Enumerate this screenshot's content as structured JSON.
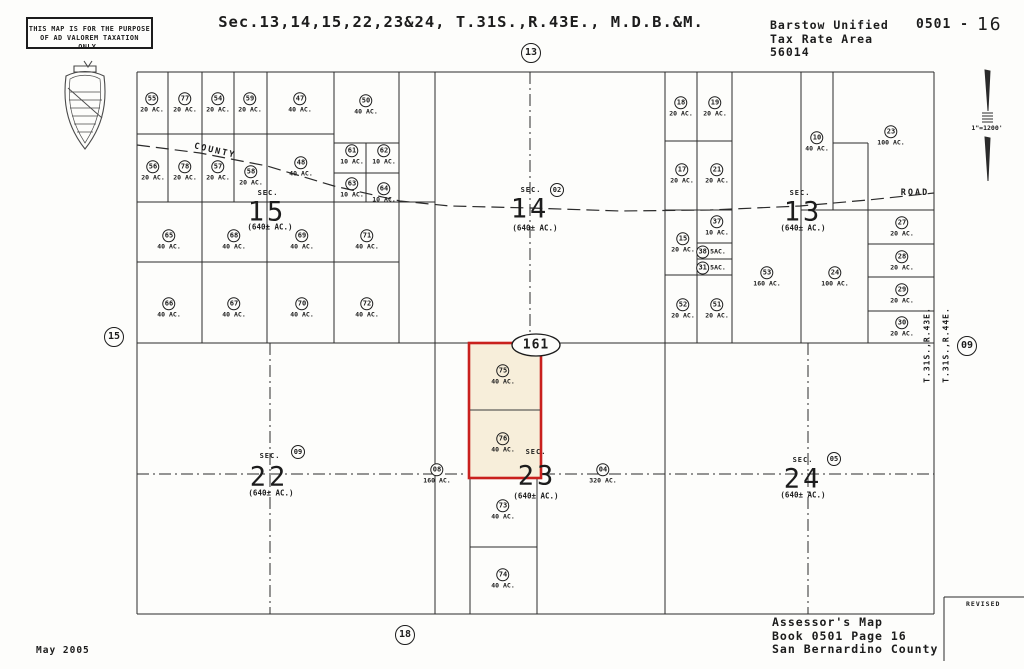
{
  "page": {
    "stamp": [
      "THIS MAP IS FOR THE PURPOSE",
      "OF AD VALOREM TAXATION ONLY."
    ],
    "title": "Sec.13,14,15,22,23&24, T.31S.,R.43E., M.D.B.&M.",
    "district": [
      "Barstow Unified",
      "Tax Rate Area",
      "56014"
    ],
    "sheet_prefix": "0501 -",
    "sheet_page": "16",
    "scale": "1\"=1200'",
    "date": "May 2005",
    "revised": "REVISED",
    "assessor": [
      "Assessor's Map",
      "Book 0501 Page 16",
      "San Bernardino County"
    ],
    "townships": [
      "T.31S.,R.43E.",
      "T.31S.,R.44E."
    ]
  },
  "edge_refs": {
    "top": "13",
    "left": "15",
    "right": "09",
    "bottom": "18"
  },
  "roads": {
    "county": "COUNTY",
    "road": "ROAD"
  },
  "highlight": {
    "flag": "161"
  },
  "sections": [
    {
      "sec": "SEC.",
      "num": "15",
      "size": "(640± AC.)"
    },
    {
      "sec": "SEC.",
      "num": "14",
      "size": "(640± AC.)",
      "ref": "02"
    },
    {
      "sec": "SEC.",
      "num": "13",
      "size": "(640± AC.)"
    },
    {
      "sec": "SEC.",
      "num": "22",
      "size": "(640± AC.)",
      "ref": "09"
    },
    {
      "sec": "SEC.",
      "num": "23",
      "size": "(640± AC.)"
    },
    {
      "sec": "SEC.",
      "num": "24",
      "size": "(640± AC.)",
      "ref": "05"
    }
  ],
  "parcels": [
    {
      "num": "55",
      "ac": "20 AC."
    },
    {
      "num": "77",
      "ac": "20 AC."
    },
    {
      "num": "54",
      "ac": "20 AC."
    },
    {
      "num": "59",
      "ac": "20 AC."
    },
    {
      "num": "47",
      "ac": "40 AC."
    },
    {
      "num": "50",
      "ac": "40 AC."
    },
    {
      "num": "56",
      "ac": "20 AC."
    },
    {
      "num": "78",
      "ac": "20 AC."
    },
    {
      "num": "57",
      "ac": "20 AC."
    },
    {
      "num": "58",
      "ac": "20 AC."
    },
    {
      "num": "48",
      "ac": "40 AC."
    },
    {
      "num": "61",
      "ac": "10 AC."
    },
    {
      "num": "62",
      "ac": "10 AC."
    },
    {
      "num": "63",
      "ac": "10 AC."
    },
    {
      "num": "64",
      "ac": "10 AC."
    },
    {
      "num": "65",
      "ac": "40 AC."
    },
    {
      "num": "68",
      "ac": "40 AC."
    },
    {
      "num": "69",
      "ac": "40 AC."
    },
    {
      "num": "71",
      "ac": "40 AC."
    },
    {
      "num": "66",
      "ac": "40 AC."
    },
    {
      "num": "67",
      "ac": "40 AC."
    },
    {
      "num": "70",
      "ac": "40 AC."
    },
    {
      "num": "72",
      "ac": "40 AC."
    },
    {
      "num": "18",
      "ac": "20 AC."
    },
    {
      "num": "19",
      "ac": "20 AC."
    },
    {
      "num": "10",
      "ac": "40 AC."
    },
    {
      "num": "23",
      "ac": "100 AC."
    },
    {
      "num": "17",
      "ac": "20 AC."
    },
    {
      "num": "21",
      "ac": "20 AC."
    },
    {
      "num": "37",
      "ac": "10 AC."
    },
    {
      "num": "15",
      "ac": "20 AC."
    },
    {
      "num": "38",
      "ac": "5AC."
    },
    {
      "num": "31",
      "ac": "5AC."
    },
    {
      "num": "53",
      "ac": "160 AC."
    },
    {
      "num": "24",
      "ac": "100 AC."
    },
    {
      "num": "27",
      "ac": "20 AC."
    },
    {
      "num": "28",
      "ac": "20 AC."
    },
    {
      "num": "29",
      "ac": "20 AC."
    },
    {
      "num": "30",
      "ac": "20 AC."
    },
    {
      "num": "52",
      "ac": "20 AC."
    },
    {
      "num": "51",
      "ac": "20 AC."
    },
    {
      "num": "75",
      "ac": "40 AC."
    },
    {
      "num": "76",
      "ac": "40 AC."
    },
    {
      "num": "73",
      "ac": "40 AC."
    },
    {
      "num": "74",
      "ac": "40 AC."
    },
    {
      "num": "08",
      "ac": "160 AC."
    },
    {
      "num": "04",
      "ac": "320 AC."
    }
  ]
}
